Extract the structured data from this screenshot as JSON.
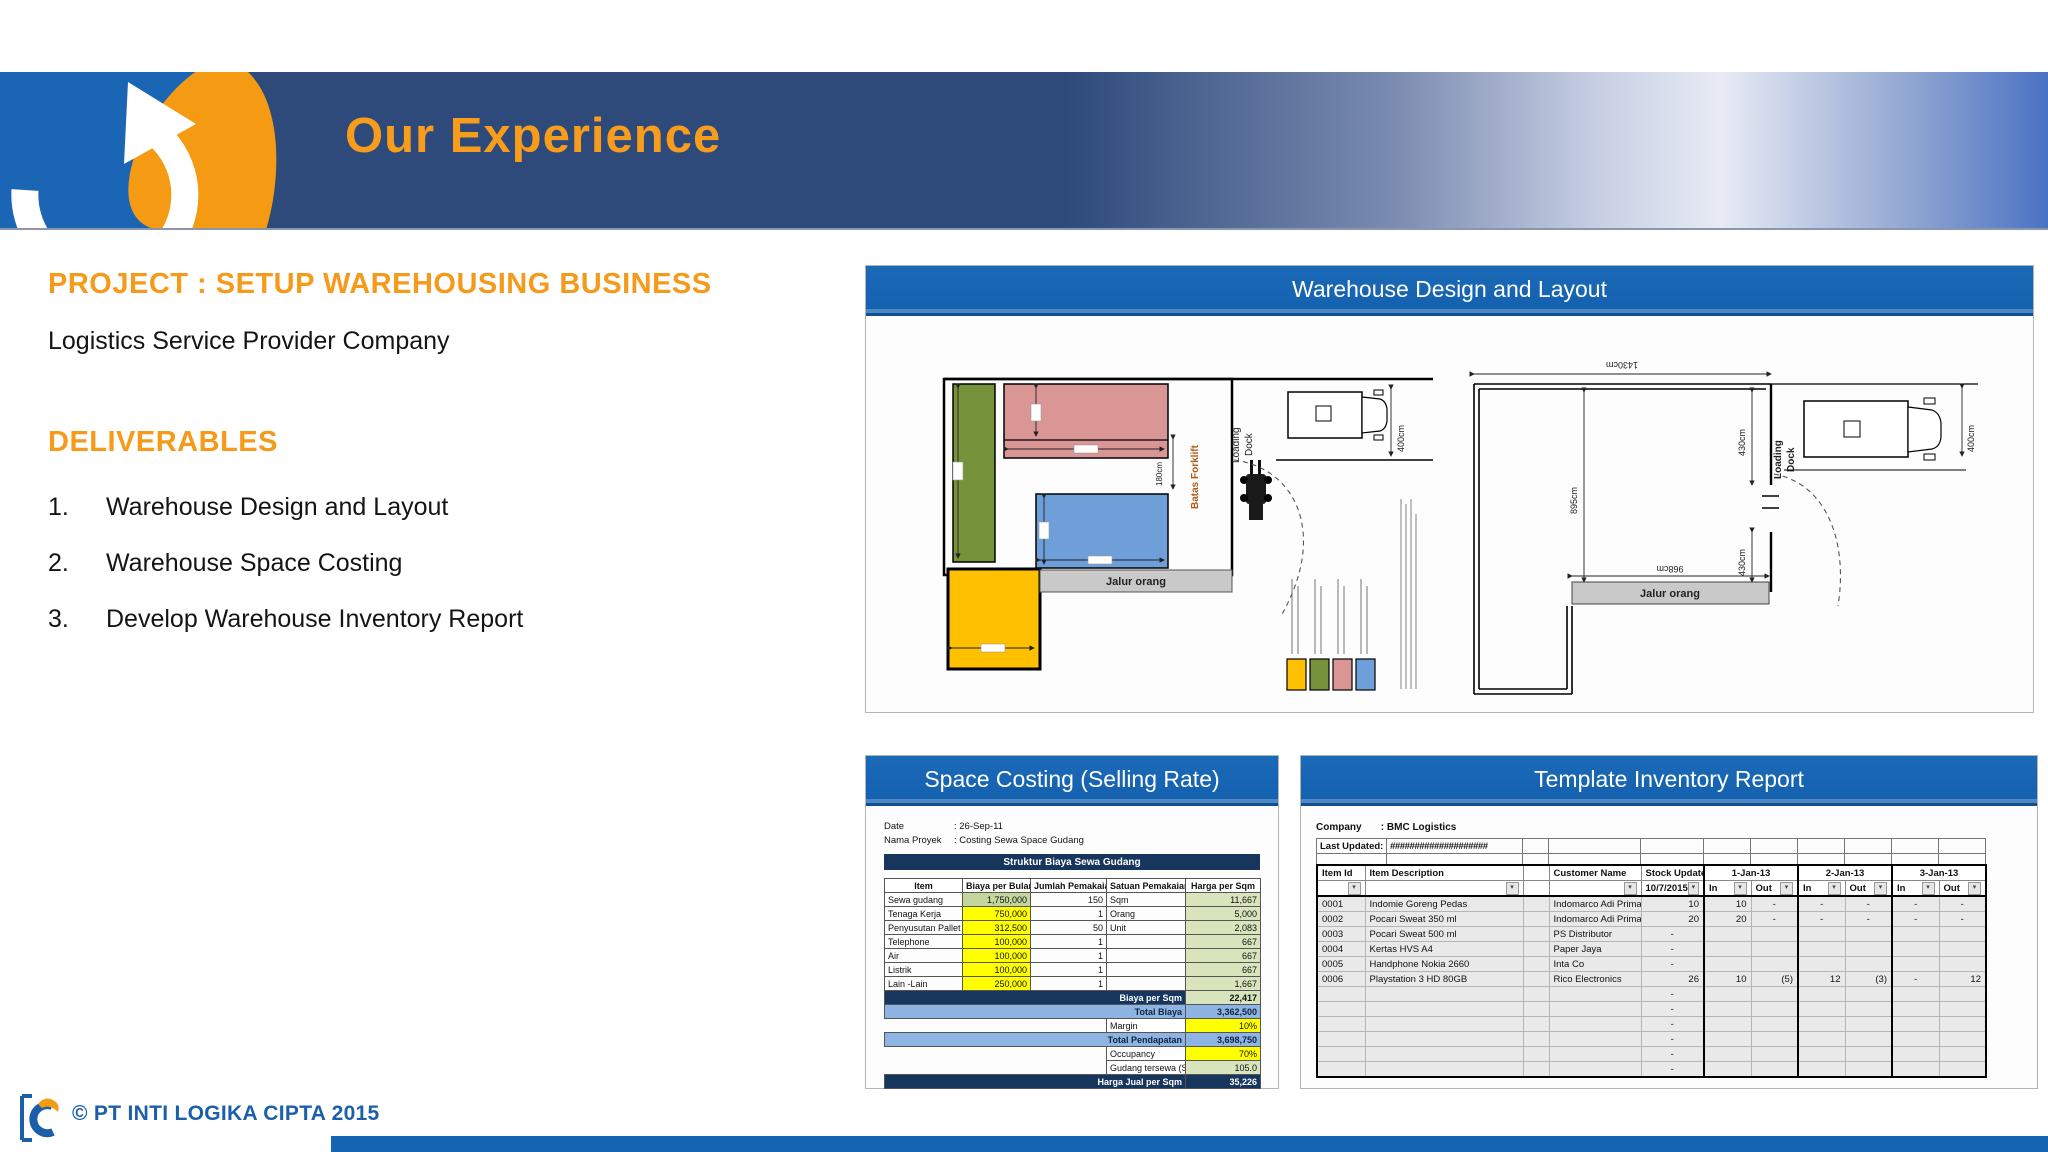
{
  "header": {
    "title": "Our Experience"
  },
  "intro": {
    "project_title": "PROJECT : SETUP WAREHOUSING BUSINESS",
    "company": "Logistics Service Provider Company",
    "deliverables_heading": "DELIVERABLES",
    "deliverables": [
      {
        "num": "1.",
        "text": "Warehouse Design and Layout"
      },
      {
        "num": "2.",
        "text": "Warehouse Space Costing"
      },
      {
        "num": "3.",
        "text": "Develop Warehouse Inventory Report"
      }
    ]
  },
  "layout_panel": {
    "title": "Warehouse Design and Layout",
    "left_plan": {
      "jalur_orang": "Jalur orang",
      "batas_forklift": "Batas Forklift",
      "loading": "Loading",
      "dock": "Dock",
      "dim_forklift": "180cm",
      "dim_truck": "400cm",
      "legend_colors": [
        "#ffc000",
        "#76933c",
        "#d99694",
        "#6f9fd8"
      ]
    },
    "right_plan": {
      "dim_top": "1430cm",
      "dim_left": "895cm",
      "dim_right_upper": "430cm",
      "dim_right_lower": "430cm",
      "dim_inner": "968cm",
      "dim_truck": "400cm",
      "jalur_orang": "Jalur orang",
      "loading": "Loading",
      "dock": "Dock"
    }
  },
  "costing_panel": {
    "title": "Space Costing (Selling Rate)",
    "meta": {
      "date_label": "Date",
      "date_value": ": 26-Sep-11",
      "project_label": "Nama Proyek",
      "project_value": ": Costing Sewa Space Gudang"
    },
    "section_header": "Struktur Biaya Sewa Gudang",
    "columns": [
      "Item",
      "Biaya per Bulan",
      "Jumlah Pemakaian",
      "Satuan Pemakaian",
      "Harga per Sqm"
    ],
    "rows": [
      {
        "item": "Sewa gudang",
        "biaya": "1,750,000",
        "jumlah": "150",
        "satuan": "Sqm",
        "harga": "11,667",
        "biaya_class": "bg-green"
      },
      {
        "item": "Tenaga Kerja",
        "biaya": "750,000",
        "jumlah": "1",
        "satuan": "Orang",
        "harga": "5,000",
        "biaya_class": "bg-yellow"
      },
      {
        "item": "Penyusutan Pallet",
        "biaya": "312,500",
        "jumlah": "50",
        "satuan": "Unit",
        "harga": "2,083",
        "biaya_class": "bg-yellow"
      },
      {
        "item": "Telephone",
        "biaya": "100,000",
        "jumlah": "1",
        "satuan": "",
        "harga": "667",
        "biaya_class": "bg-yellow"
      },
      {
        "item": "Air",
        "biaya": "100,000",
        "jumlah": "1",
        "satuan": "",
        "harga": "667",
        "biaya_class": "bg-yellow"
      },
      {
        "item": "Listrik",
        "biaya": "100,000",
        "jumlah": "1",
        "satuan": "",
        "harga": "667",
        "biaya_class": "bg-yellow"
      },
      {
        "item": "Lain -Lain",
        "biaya": "250,000",
        "jumlah": "1",
        "satuan": "",
        "harga": "1,667",
        "biaya_class": "bg-yellow"
      }
    ],
    "summary": [
      {
        "label": "Biaya per Sqm",
        "value": "22,417"
      },
      {
        "label": "Total Biaya",
        "value": "3,362,500"
      },
      {
        "label": "Margin",
        "value": "10%"
      },
      {
        "label": "Total Pendapatan",
        "value": "3,698,750"
      },
      {
        "label": "Occupancy",
        "value": "70%"
      },
      {
        "label": "Gudang tersewa (Sqm)",
        "value": "105.0"
      },
      {
        "label": "Harga Jual per Sqm",
        "value": "35,226"
      }
    ]
  },
  "inventory_panel": {
    "title": "Template Inventory Report",
    "company_label": "Company",
    "company_value": ":  BMC Logistics",
    "last_updated_label": "Last Updated:",
    "last_updated_value": "####################",
    "col_item_id": "Item Id",
    "col_item_desc": "Item Description",
    "col_customer": "Customer Name",
    "col_stock": "Stock Update",
    "stock_date": "10/7/2015",
    "date_groups": [
      "1-Jan-13",
      "2-Jan-13",
      "3-Jan-13"
    ],
    "col_in": "In",
    "col_out": "Out",
    "filter_glyph": "▾",
    "rows": [
      {
        "id": "0001",
        "desc": "Indomie Goreng Pedas",
        "customer": "Indomarco Adi Prima",
        "stock": "10",
        "d1in": "10",
        "d1out": "-",
        "d2in": "-",
        "d2out": "-",
        "d3in": "-",
        "d3out": "-"
      },
      {
        "id": "0002",
        "desc": "Pocari Sweat 350 ml",
        "customer": "Indomarco Adi Prima",
        "stock": "20",
        "d1in": "20",
        "d1out": "-",
        "d2in": "-",
        "d2out": "-",
        "d3in": "-",
        "d3out": "-"
      },
      {
        "id": "0003",
        "desc": "Pocari Sweat 500 ml",
        "customer": "PS Distributor",
        "stock": "-",
        "d1in": "",
        "d1out": "",
        "d2in": "",
        "d2out": "",
        "d3in": "",
        "d3out": ""
      },
      {
        "id": "0004",
        "desc": "Kertas HVS A4",
        "customer": "Paper Jaya",
        "stock": "-",
        "d1in": "",
        "d1out": "",
        "d2in": "",
        "d2out": "",
        "d3in": "",
        "d3out": ""
      },
      {
        "id": "0005",
        "desc": "Handphone Nokia 2660",
        "customer": "Inta Co",
        "stock": "-",
        "d1in": "",
        "d1out": "",
        "d2in": "",
        "d2out": "",
        "d3in": "",
        "d3out": ""
      },
      {
        "id": "0006",
        "desc": "Playstation 3 HD 80GB",
        "customer": "Rico Electronics",
        "stock": "26",
        "d1in": "10",
        "d1out": "(5)",
        "d2in": "12",
        "d2out": "(3)",
        "d3in": "-",
        "d3out": "12"
      },
      {
        "id": "",
        "desc": "",
        "customer": "",
        "stock": "-",
        "d1in": "",
        "d1out": "",
        "d2in": "",
        "d2out": "",
        "d3in": "",
        "d3out": ""
      },
      {
        "id": "",
        "desc": "",
        "customer": "",
        "stock": "-",
        "d1in": "",
        "d1out": "",
        "d2in": "",
        "d2out": "",
        "d3in": "",
        "d3out": ""
      },
      {
        "id": "",
        "desc": "",
        "customer": "",
        "stock": "-",
        "d1in": "",
        "d1out": "",
        "d2in": "",
        "d2out": "",
        "d3in": "",
        "d3out": ""
      },
      {
        "id": "",
        "desc": "",
        "customer": "",
        "stock": "-",
        "d1in": "",
        "d1out": "",
        "d2in": "",
        "d2out": "",
        "d3in": "",
        "d3out": ""
      },
      {
        "id": "",
        "desc": "",
        "customer": "",
        "stock": "-",
        "d1in": "",
        "d1out": "",
        "d2in": "",
        "d2out": "",
        "d3in": "",
        "d3out": ""
      },
      {
        "id": "",
        "desc": "",
        "customer": "",
        "stock": "-",
        "d1in": "",
        "d1out": "",
        "d2in": "",
        "d2out": "",
        "d3in": "",
        "d3out": ""
      }
    ]
  },
  "footer": {
    "copyright": "© PT INTI LOGIKA CIPTA 2015"
  }
}
